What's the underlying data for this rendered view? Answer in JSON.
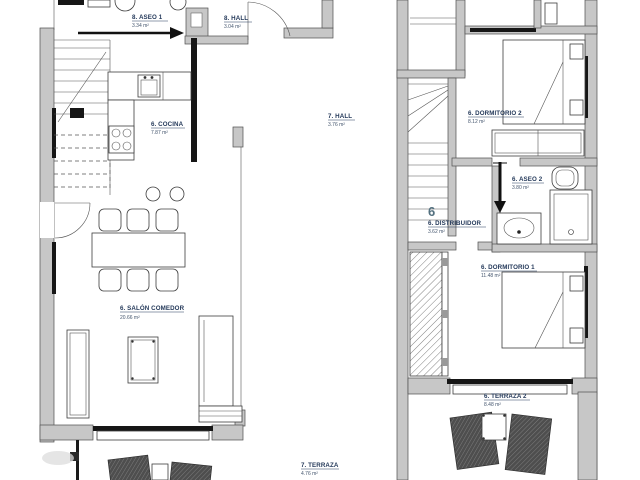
{
  "document": {
    "type": "architectural floor plan",
    "background": "#ffffff"
  },
  "colors": {
    "wall_fill": "#c7c7c7",
    "wall_stroke": "#4f4f4f",
    "line": "#3d3d3d",
    "label_text": "#24395a",
    "area_text": "#45566e",
    "unit_number": "#53707f",
    "lounger_fill": "#4e4e4e"
  },
  "left_plan": {
    "name": "lower floor plan",
    "rooms": [
      {
        "label": "8. ASEO 1",
        "area": "3.34 m²"
      },
      {
        "label": "8. HALL",
        "area": "3.04 m²"
      },
      {
        "label": "6. COCINA",
        "area": "7.87 m²"
      },
      {
        "label": "7. HALL",
        "area": "3.76 m²"
      },
      {
        "label": "6. SALÓN COMEDOR",
        "area": "20.66 m²"
      },
      {
        "label": "7. TERRAZA",
        "area": "4.76 m²"
      }
    ]
  },
  "right_plan": {
    "name": "upper floor plan",
    "unit_number": "6",
    "rooms": [
      {
        "label": "6. DORMITORIO 2",
        "area": "8.12 m²"
      },
      {
        "label": "6. ASEO 2",
        "area": "3.80 m²"
      },
      {
        "label": "6. DISTRIBUIDOR",
        "area": "3.62 m²"
      },
      {
        "label": "6. DORMITORIO 1",
        "area": "11.48 m²"
      },
      {
        "label": "6. TERRAZA 2",
        "area": "8.48 m²"
      }
    ]
  }
}
